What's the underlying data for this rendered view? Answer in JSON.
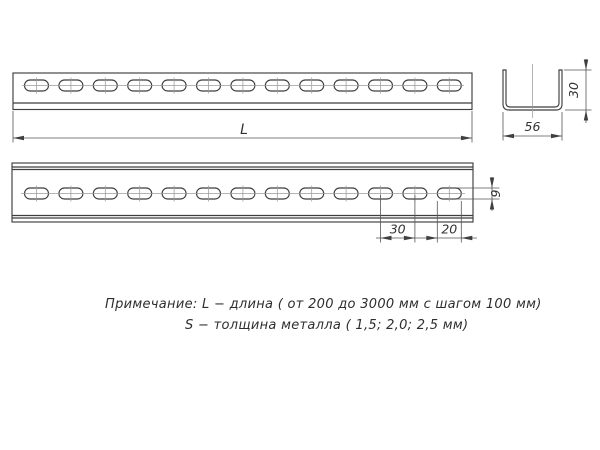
{
  "note": {
    "line1": "Примечание: L − длина ( от 200 до 3000 мм с шагом 100 мм)",
    "line2": "S − толщина металла ( 1,5; 2,0; 2,5 мм)"
  },
  "dimensions": {
    "length_label": "L",
    "profile_width": "56",
    "profile_height": "30",
    "hole_pitch": "30",
    "hole_length": "20",
    "hole_width": "9"
  },
  "slots": {
    "count": 13,
    "first_cx": 36.5,
    "pitch": 34.4,
    "width": 24,
    "height": 11,
    "view1_cy": 85.5,
    "view2_cy": 193.5
  },
  "colors": {
    "line": "#3f3f3f",
    "thin_line": "#555555",
    "centerline": "#9b9b9b",
    "text": "#333333",
    "background": "#ffffff"
  }
}
